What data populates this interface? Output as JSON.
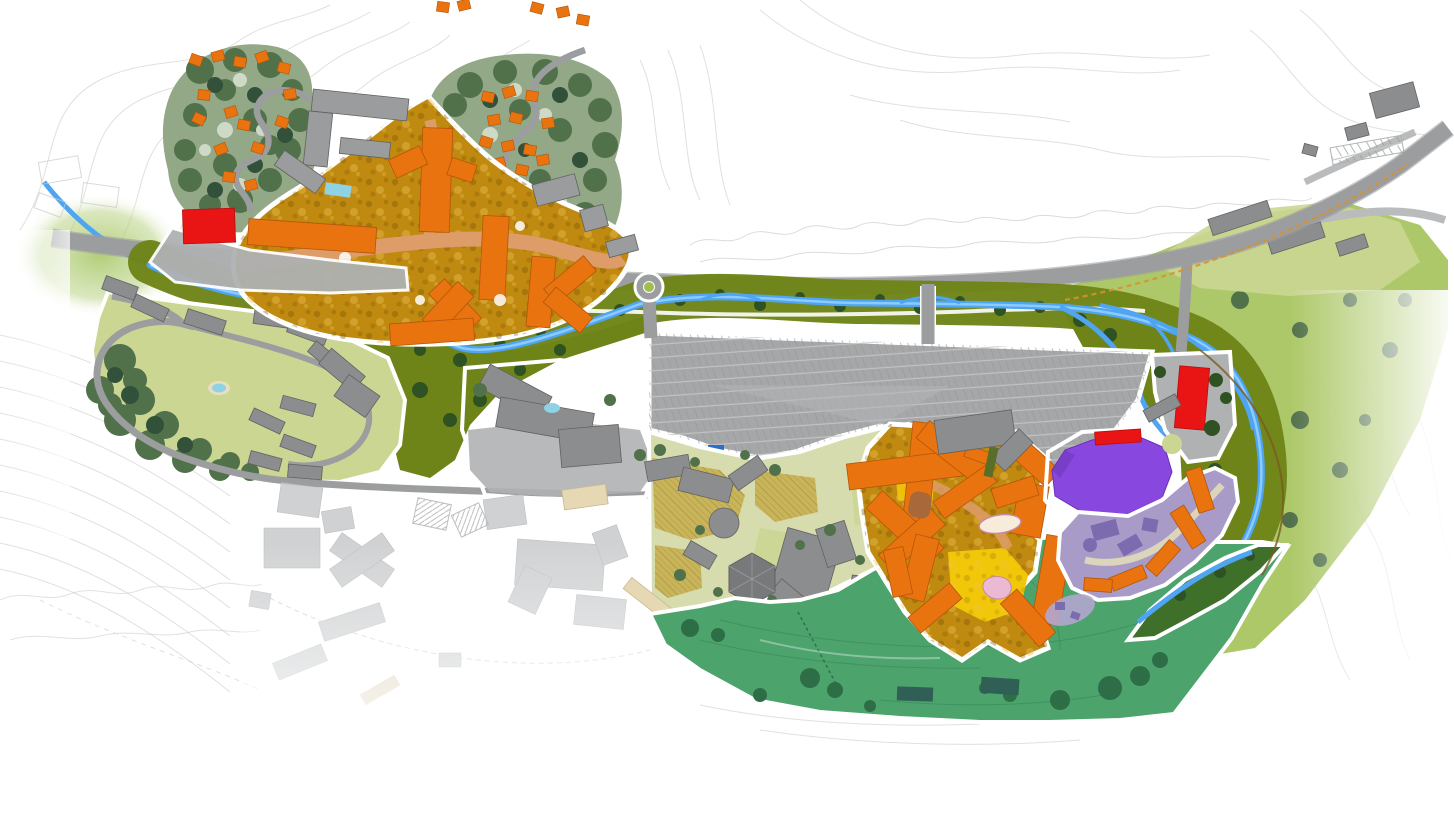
{
  "map": {
    "kind": "illustrated-resort-master-plan",
    "canvas": {
      "width": 1454,
      "height": 814
    },
    "visible_text": [],
    "colors": {
      "background": "#ffffff",
      "outline": "#ffffff",
      "contour": "#e0e0e0",
      "sketch": "#c9c9c9",
      "road": "#9b9d9e",
      "road_light": "#b9bbbc",
      "apron": "#afb1b2",
      "parking": "#a5a7a8",
      "parking_stripe": "#c6c8c9",
      "existing_building": "#8b8d8e",
      "existing_building_edge": "#606263",
      "top_building": "#9a9c9d",
      "faded_building": "#c4c6c7",
      "proposed_building": "#e8730f",
      "proposed_edge": "#b4560a",
      "gold_ground": "#c08a10",
      "gold_dark": "#7a5505",
      "gold_light": "#e8c254",
      "salmon_road": "#dd9c68",
      "courtyard_yellow": "#f2c70a",
      "red_building": "#e91414",
      "red_edge": "#b80e0e",
      "purple_building": "#8847de",
      "purple_dark": "#6a30b8",
      "lavender_ground": "#a89bc8",
      "lavender_building": "#7d6baf",
      "river": "#4fa5f2",
      "river_light": "#8ccbff",
      "riparian": "#6e8418",
      "riparian_dark": "#2f5222",
      "lawn": "#cbd693",
      "lawn_bright": "#9fbe4f",
      "pale_lawn": "#d7dcae",
      "khaki": "#c9b45a",
      "khaki_line": "#8a7a30",
      "meadow": "#4ca36c",
      "meadow_dark": "#2e6e46",
      "meadow_line": "#35855a",
      "wedge_green": "#3f7029",
      "teal_building": "#2f5f55",
      "forest_base": "#93a886",
      "forest_dark": "#51714b",
      "forest_deep": "#32513a",
      "forest_pale": "#cfdac6",
      "pool": "#8fd2e4",
      "beige_building": "#e7d8b4",
      "cream_pond": "#f7ebd9",
      "pink_pond": "#ebb9d2",
      "pink_edge": "#c888a8",
      "brown_building": "#a8683a",
      "trail_orange": "#d79130",
      "trail_brown": "#7a5a20",
      "path_pale": "#e8e2b8",
      "olive_bar": "#5a6e2a",
      "shuttle_blue": "#2a6fd0"
    },
    "regions": [
      {
        "id": "upper-village-core",
        "desc": "orange proposed buildings on gold ground with salmon internal road",
        "color": "proposed_building"
      },
      {
        "id": "cabin-forest-west",
        "desc": "wooded parcel with scattered orange cabins and winding drive",
        "cabins": 15
      },
      {
        "id": "cabin-forest-east",
        "desc": "wooded parcel with scattered orange cabins and switchback drive",
        "cabins": 17
      },
      {
        "id": "lower-village-core",
        "desc": "second cluster of orange buildings with yellow courtyards and ponds",
        "color": "proposed_building"
      },
      {
        "id": "purple-venue",
        "desc": "large faceted purple building with red bar on its north edge",
        "color": "purple_building"
      },
      {
        "id": "lavender-plaza-district",
        "desc": "mauve plaza with arc of small orange buildings",
        "color": "lavender_ground"
      },
      {
        "id": "red-buildings",
        "desc": "three bright red buildings (west apron, venue edge, east apron)",
        "count": 3
      },
      {
        "id": "surface-parking-lot",
        "desc": "large gray striped parking field between river and villages"
      },
      {
        "id": "river-corridor",
        "desc": "blue creek with braided delta in olive-green riparian band"
      },
      {
        "id": "main-road",
        "desc": "gray arterial road running west-east then climbing northeast",
        "roundabouts": 1,
        "bridges": 2
      },
      {
        "id": "west-condo-neighborhood",
        "desc": "existing gray condo bars on lawns with loop drive and pool"
      },
      {
        "id": "resort-complex",
        "desc": "existing gray hotel complex with pool south of river"
      },
      {
        "id": "faded-existing-town",
        "desc": "ghosted light-gray town fabric fading out to the southwest"
      },
      {
        "id": "middle-village",
        "desc": "infill blocks on khaki cross-hatched plazas with gray buildings and hex pavilion"
      },
      {
        "id": "south-meadow",
        "desc": "large green open-space meadow with tree clumps and two teal buildings"
      },
      {
        "id": "east-hillside",
        "desc": "yellow-green hillside lawn fading to contours on the east"
      },
      {
        "id": "east-condos",
        "desc": "gray condo bars on lawns along upper east road"
      }
    ],
    "features": {
      "pools": 3,
      "ponds": 2,
      "roundabout_count": 1,
      "bridge_count": 2,
      "shuttle_stop_marker": 1,
      "trails": [
        "orange-dashed-trail-east",
        "brown-trail-delta",
        "faded-dashed-paths-southwest"
      ]
    }
  }
}
